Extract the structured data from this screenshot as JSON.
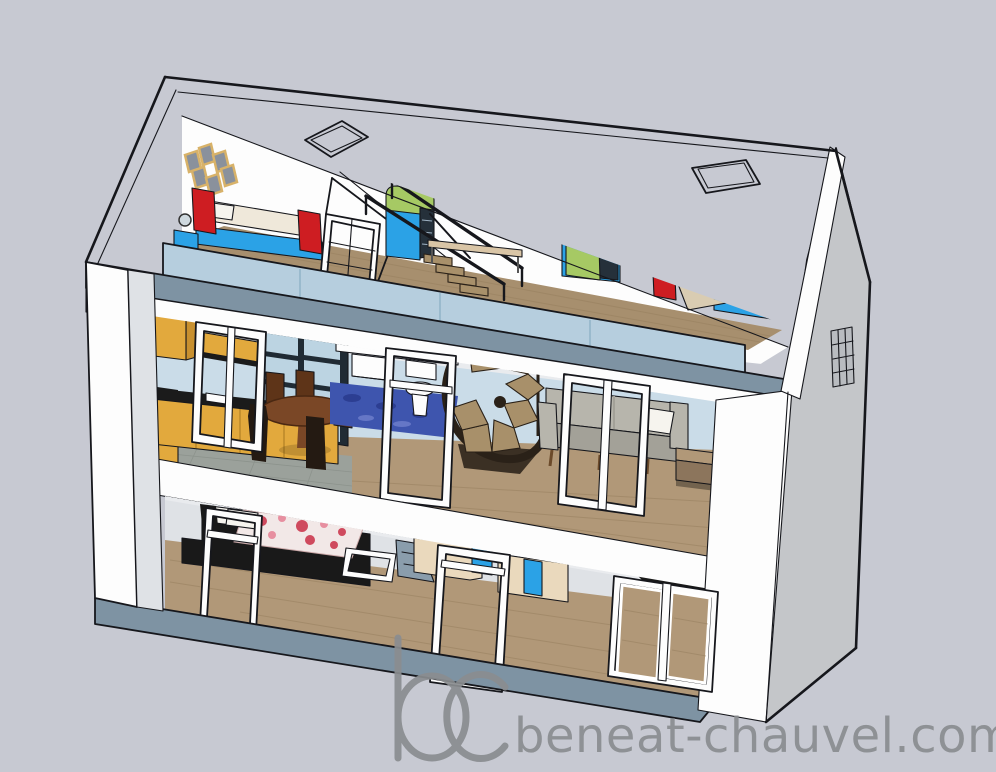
{
  "page": {
    "background": "#c7c9d2"
  },
  "watermark": {
    "logo_text": "bc",
    "site_text": "beneat-chauvel.com",
    "color": "#8a8d90"
  },
  "scene": {
    "type": "3d-house-cutaway-render",
    "roof_skylights": 2,
    "floors": [
      {
        "name": "attic",
        "items": [
          "picture-frames",
          "bed-left",
          "vanity-mirror",
          "roof-window",
          "wardrobe-left",
          "stair-railing",
          "bench",
          "wardrobe-right",
          "bed-right"
        ]
      },
      {
        "name": "middle-floor",
        "items": [
          "kitchen-cabinets",
          "glass-partition",
          "dining-table",
          "dining-chairs",
          "blue-rug",
          "washbasin",
          "toilet",
          "spiral-staircase",
          "sofa",
          "french-door-frames",
          "step-platform"
        ]
      },
      {
        "name": "ground-floor",
        "items": [
          "double-bed-floral",
          "nightstand",
          "window-frame",
          "closet-units",
          "interior-door-frame",
          "sliding-door",
          "sideboard",
          "basement-stairs"
        ]
      }
    ]
  },
  "colors": {
    "bg": "#c7c9d2",
    "outline": "#16171c",
    "white": "#fdfdfd",
    "shade": "#e9ebee",
    "wallshade": "#dfe2e6",
    "gable": "#c4c6c9",
    "slate": "#7e93a3",
    "slateb": "#8a9dac",
    "bandblue": "#b6cede",
    "seam": "#8fb2c6",
    "wallblue": "#cadce8",
    "glass": "#202b34",
    "pane": "#bcd4e2",
    "wood": "#b19878",
    "woodln": "#97805f",
    "atticwood": "#a78f6e",
    "tile": "#9ba19b",
    "tileln": "#878d87",
    "yellow": "#e2a93d",
    "yellowside": "#c8902f",
    "counter": "#1b1b1b",
    "tbl": "#7a4726",
    "tbldk": "#4a2812",
    "chair": "#5e3418",
    "chairdk": "#241a12",
    "rug": "#3e55ae",
    "rugdk": "#2c3e92",
    "ruglt": "#6577c6",
    "sofa": "#b7b5ac",
    "sofaside": "#a3a198",
    "red": "#ce1d22",
    "blue": "#2ba2e6",
    "green": "#a6c964",
    "slat": "#25303a",
    "slatln": "#9fb3c4",
    "cream": "#ead9bd",
    "creamside": "#d9c5a6",
    "duvet": "#efe8da",
    "duvettan": "#d9ccb2",
    "pillow": "#f6f4ee",
    "floral": "#f2e8e7",
    "flred": "#cf4a5e",
    "flred2": "#e78fa0",
    "blackf": "#191919",
    "dkgray": "#2a2d31",
    "stairwood": "#a8906a",
    "stairdk": "#2a2118",
    "frametan": "#d8b269",
    "framegray": "#8a919c",
    "mirror": "#cfd9df",
    "legbrown": "#6b4a2a",
    "wm": "#8a8d90"
  }
}
